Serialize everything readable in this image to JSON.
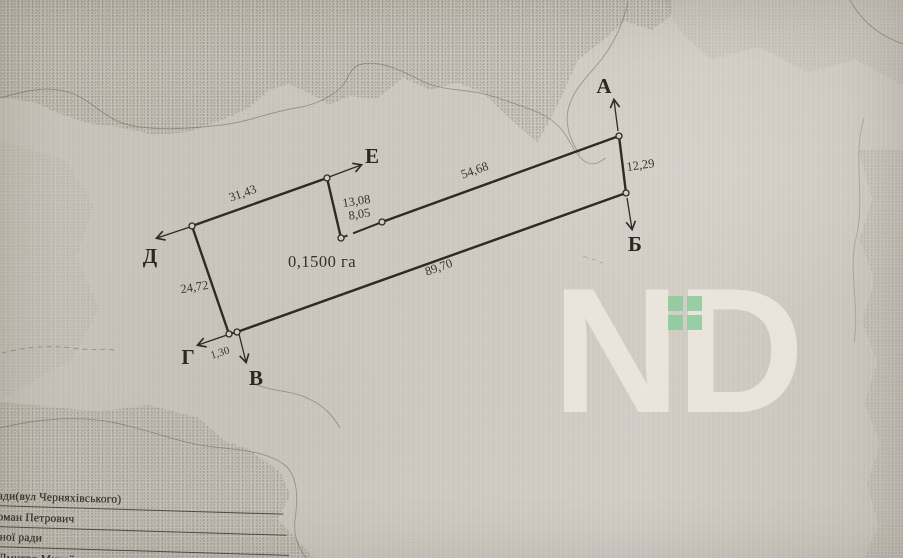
{
  "plot": {
    "area_label": "0,1500 га",
    "vertex_labels": {
      "a": "А",
      "b": "Б",
      "v": "В",
      "g": "Г",
      "d": "Д",
      "e": "Е"
    },
    "dimensions": {
      "side_d_e": "31,43",
      "side_e_p1": "13,08",
      "side_p1_p2": "8,05",
      "side_p2_a": "54,68",
      "side_a_b": "12,29",
      "side_b_v": "89,70",
      "side_v_g": "1,30",
      "side_g_d": "24,72"
    }
  },
  "watermark": {
    "n": "N",
    "d": "D",
    "accent_color": "#8ccb9c"
  },
  "footer": {
    "lines": [
      "ради(вул Черняхівського)",
      "Роман Петрович",
      "щної ради",
      "я Дмитро Михайлович"
    ]
  }
}
